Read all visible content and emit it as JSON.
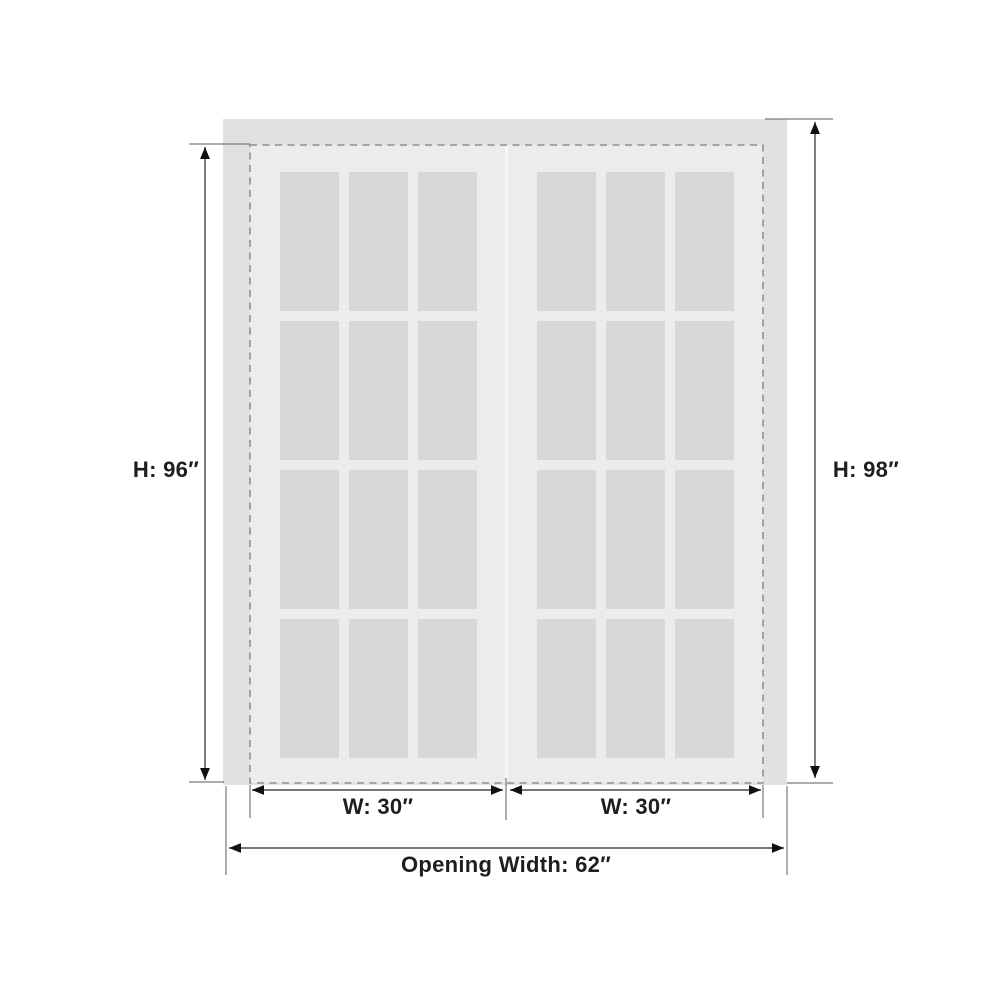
{
  "product_diagram": {
    "type": "double-door-dimension-diagram",
    "labels": {
      "door_height": "H: 96″",
      "opening_height": "H: 98″",
      "door_width_left": "W: 30″",
      "door_width_right": "W: 30″",
      "opening_width": "Opening Width: 62″"
    },
    "measurements": {
      "door_height_in": 96,
      "opening_height_in": 98,
      "door_width_in": 30,
      "opening_width_in": 62,
      "door_count": 2,
      "lite_grid_per_door": "3 columns x 4 rows"
    },
    "colors": {
      "background": "#ffffff",
      "frame_fill": "#e1e1e1",
      "door_fill": "#ececec",
      "glass_fill": "#d8d8d8",
      "dashed_outline": "#8f8f8f",
      "dimension_line": "#4a4a4a",
      "extension_line": "#7a7a7a",
      "arrow": "#111111",
      "label_text": "#1e1e1e"
    }
  }
}
